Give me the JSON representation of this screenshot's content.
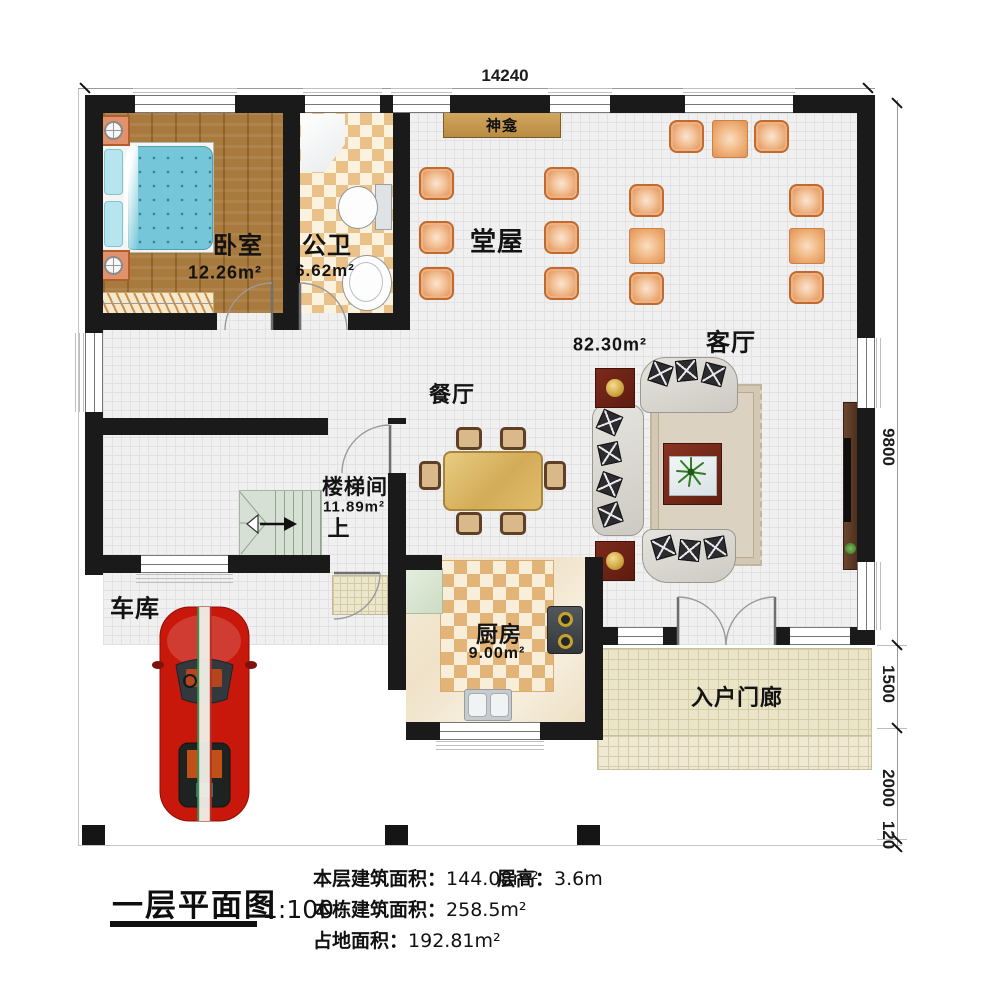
{
  "title_block": {
    "title": "一层平面图",
    "scale": "1:100",
    "items": [
      {
        "label": "本层建筑面积：",
        "value": "144.08m²"
      },
      {
        "label": "层高：",
        "value": "3.6m"
      },
      {
        "label": "本栋建筑面积：",
        "value": "258.5m²"
      },
      {
        "label": "占地面积：",
        "value": "192.81m²"
      }
    ]
  },
  "dimensions": {
    "top_width": "14240",
    "right": [
      "9800",
      "1500",
      "2000",
      "120"
    ]
  },
  "rooms": {
    "bedroom": {
      "name": "卧室",
      "area": "12.26m²"
    },
    "bathroom": {
      "name": "公卫",
      "area": "6.62m²"
    },
    "hall": {
      "name": "堂屋"
    },
    "shrine": {
      "name": "神龛"
    },
    "living": {
      "name": "客厅",
      "area": "82.30m²"
    },
    "dining": {
      "name": "餐厅"
    },
    "stairwell": {
      "name": "楼梯间",
      "area": "11.89m²",
      "direction": "上"
    },
    "garage": {
      "name": "车库"
    },
    "kitchen": {
      "name": "厨房",
      "area": "9.00m²"
    },
    "porch": {
      "name": "入户门廊"
    }
  },
  "colors": {
    "wall": "#1a1a1a",
    "wood_floor": "#a87a3e",
    "bath_tile": "#e9c189",
    "hall_floor": "#f0f0f1",
    "chair_orange": "#e79d64",
    "stair_green": "#d6e0d4",
    "porch_tan": "#eae4c9",
    "car_red": "#c8170b",
    "bed_blue": "#74c6d8",
    "shrine_wood": "#c79b55"
  }
}
